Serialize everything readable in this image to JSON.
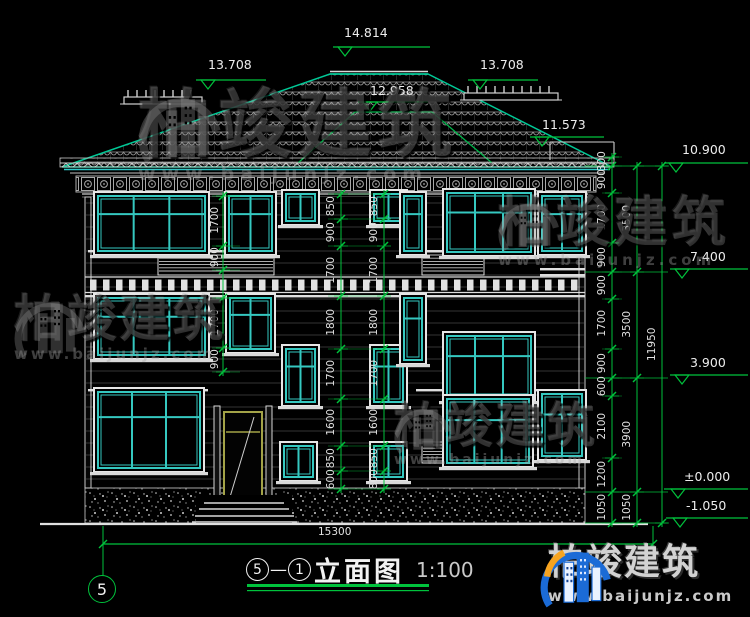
{
  "brand": {
    "name": "柏竣建筑",
    "url": "www.baijunjz.com"
  },
  "title": {
    "axis_from": "5",
    "dash": "—",
    "axis_to": "1",
    "text": "立面图",
    "scale": "1:100"
  },
  "axis": {
    "bubble": "5"
  },
  "levels": {
    "ridge": "14.814",
    "deck_left": "13.708",
    "deck_right": "13.708",
    "porch": "12.958",
    "side_eave": "11.573",
    "eave": "10.900",
    "third": "7.400",
    "second": "3.900",
    "gf": "±0.000",
    "foundation": "-1.050"
  },
  "dims": {
    "right_inner": [
      "300",
      "900",
      "1700",
      "900",
      "900",
      "1700",
      "900",
      "600",
      "2100",
      "1200",
      "1050"
    ],
    "right_floors": [
      "3500",
      "3500",
      "3900",
      "1050"
    ],
    "right_total": [
      "11950"
    ],
    "stair_left": [
      "850",
      "900",
      "1700",
      "1800",
      "1700",
      "1600",
      "850",
      "600"
    ],
    "stair_right": [
      "850",
      "900",
      "1700",
      "1800",
      "1700",
      "1600",
      "850",
      "800"
    ],
    "left_windows": [
      "1700",
      "900",
      "1700",
      "900"
    ],
    "bottom_width": [
      "15300"
    ]
  }
}
